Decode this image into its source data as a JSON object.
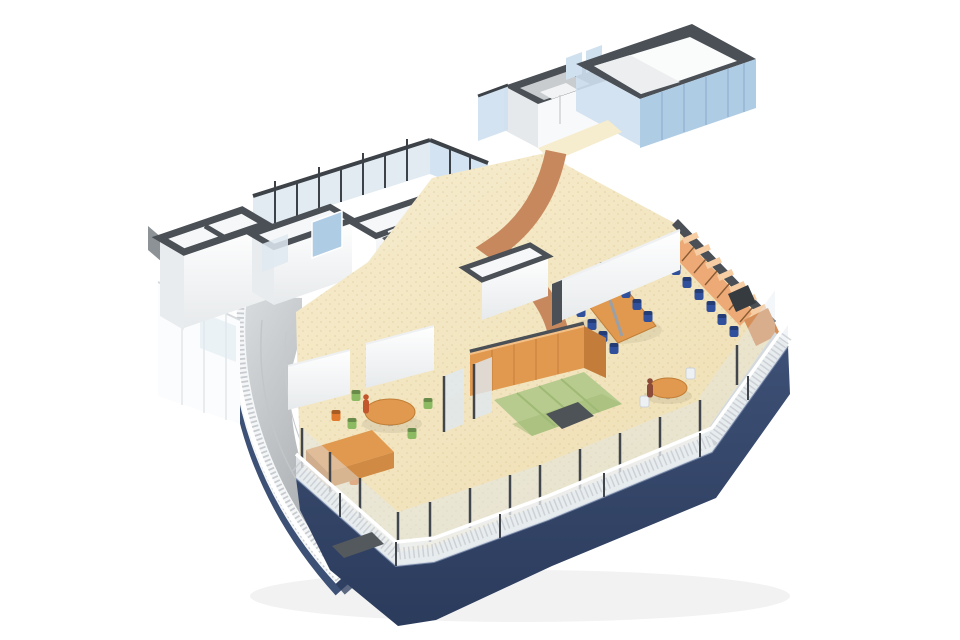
{
  "scene": {
    "description": "3D axonometric cutaway rendering of a building floor plan",
    "style": "architectural visualization",
    "people_visible": 2
  },
  "colors": {
    "background": "#ffffff",
    "wall_cap": "#4a5056",
    "wall_cap_dark": "#363b40",
    "wall_white": "#ffffff",
    "wall_shade": "#e7eaec",
    "glass_blue": "#afcce5",
    "glass_blue_light": "#cfe0ef",
    "glass_pale": "#dfe9f1",
    "glass_frame": "#3c4247",
    "floor_tan": "#efdfb4",
    "floor_tan_light": "#f6ecce",
    "path_brown": "#c8885e",
    "wood": "#e1994f",
    "wood_dark": "#c47c3a",
    "carrel_front": "#edaa76",
    "carrel_top": "#f7cda4",
    "carrel_side": "#d68f58",
    "chair_blue": "#30509c",
    "chair_green": "#8cba62",
    "chair_orange": "#e07a2e",
    "mat_green": "#b7cb8f",
    "mat_green_dark": "#9fba74",
    "table_dark": "#4e5357",
    "stair_wood": "#d8a45f",
    "terrace_light": "#dadddf",
    "terrace_dark": "#9ea2a6",
    "balustrade": "#f4f6f7",
    "balustrade_dot": "#c7cbcf",
    "navy": "#3d5075",
    "navy_dark": "#2b3b5c",
    "navy_light": "#7e90b0",
    "rail_glass": "#eef2f5",
    "rail_post": "#41464c",
    "walkway": "#d3d9dc",
    "person_brown": "#8c4a38",
    "person_red": "#c2572e",
    "roof_gray": "#8d9296"
  }
}
